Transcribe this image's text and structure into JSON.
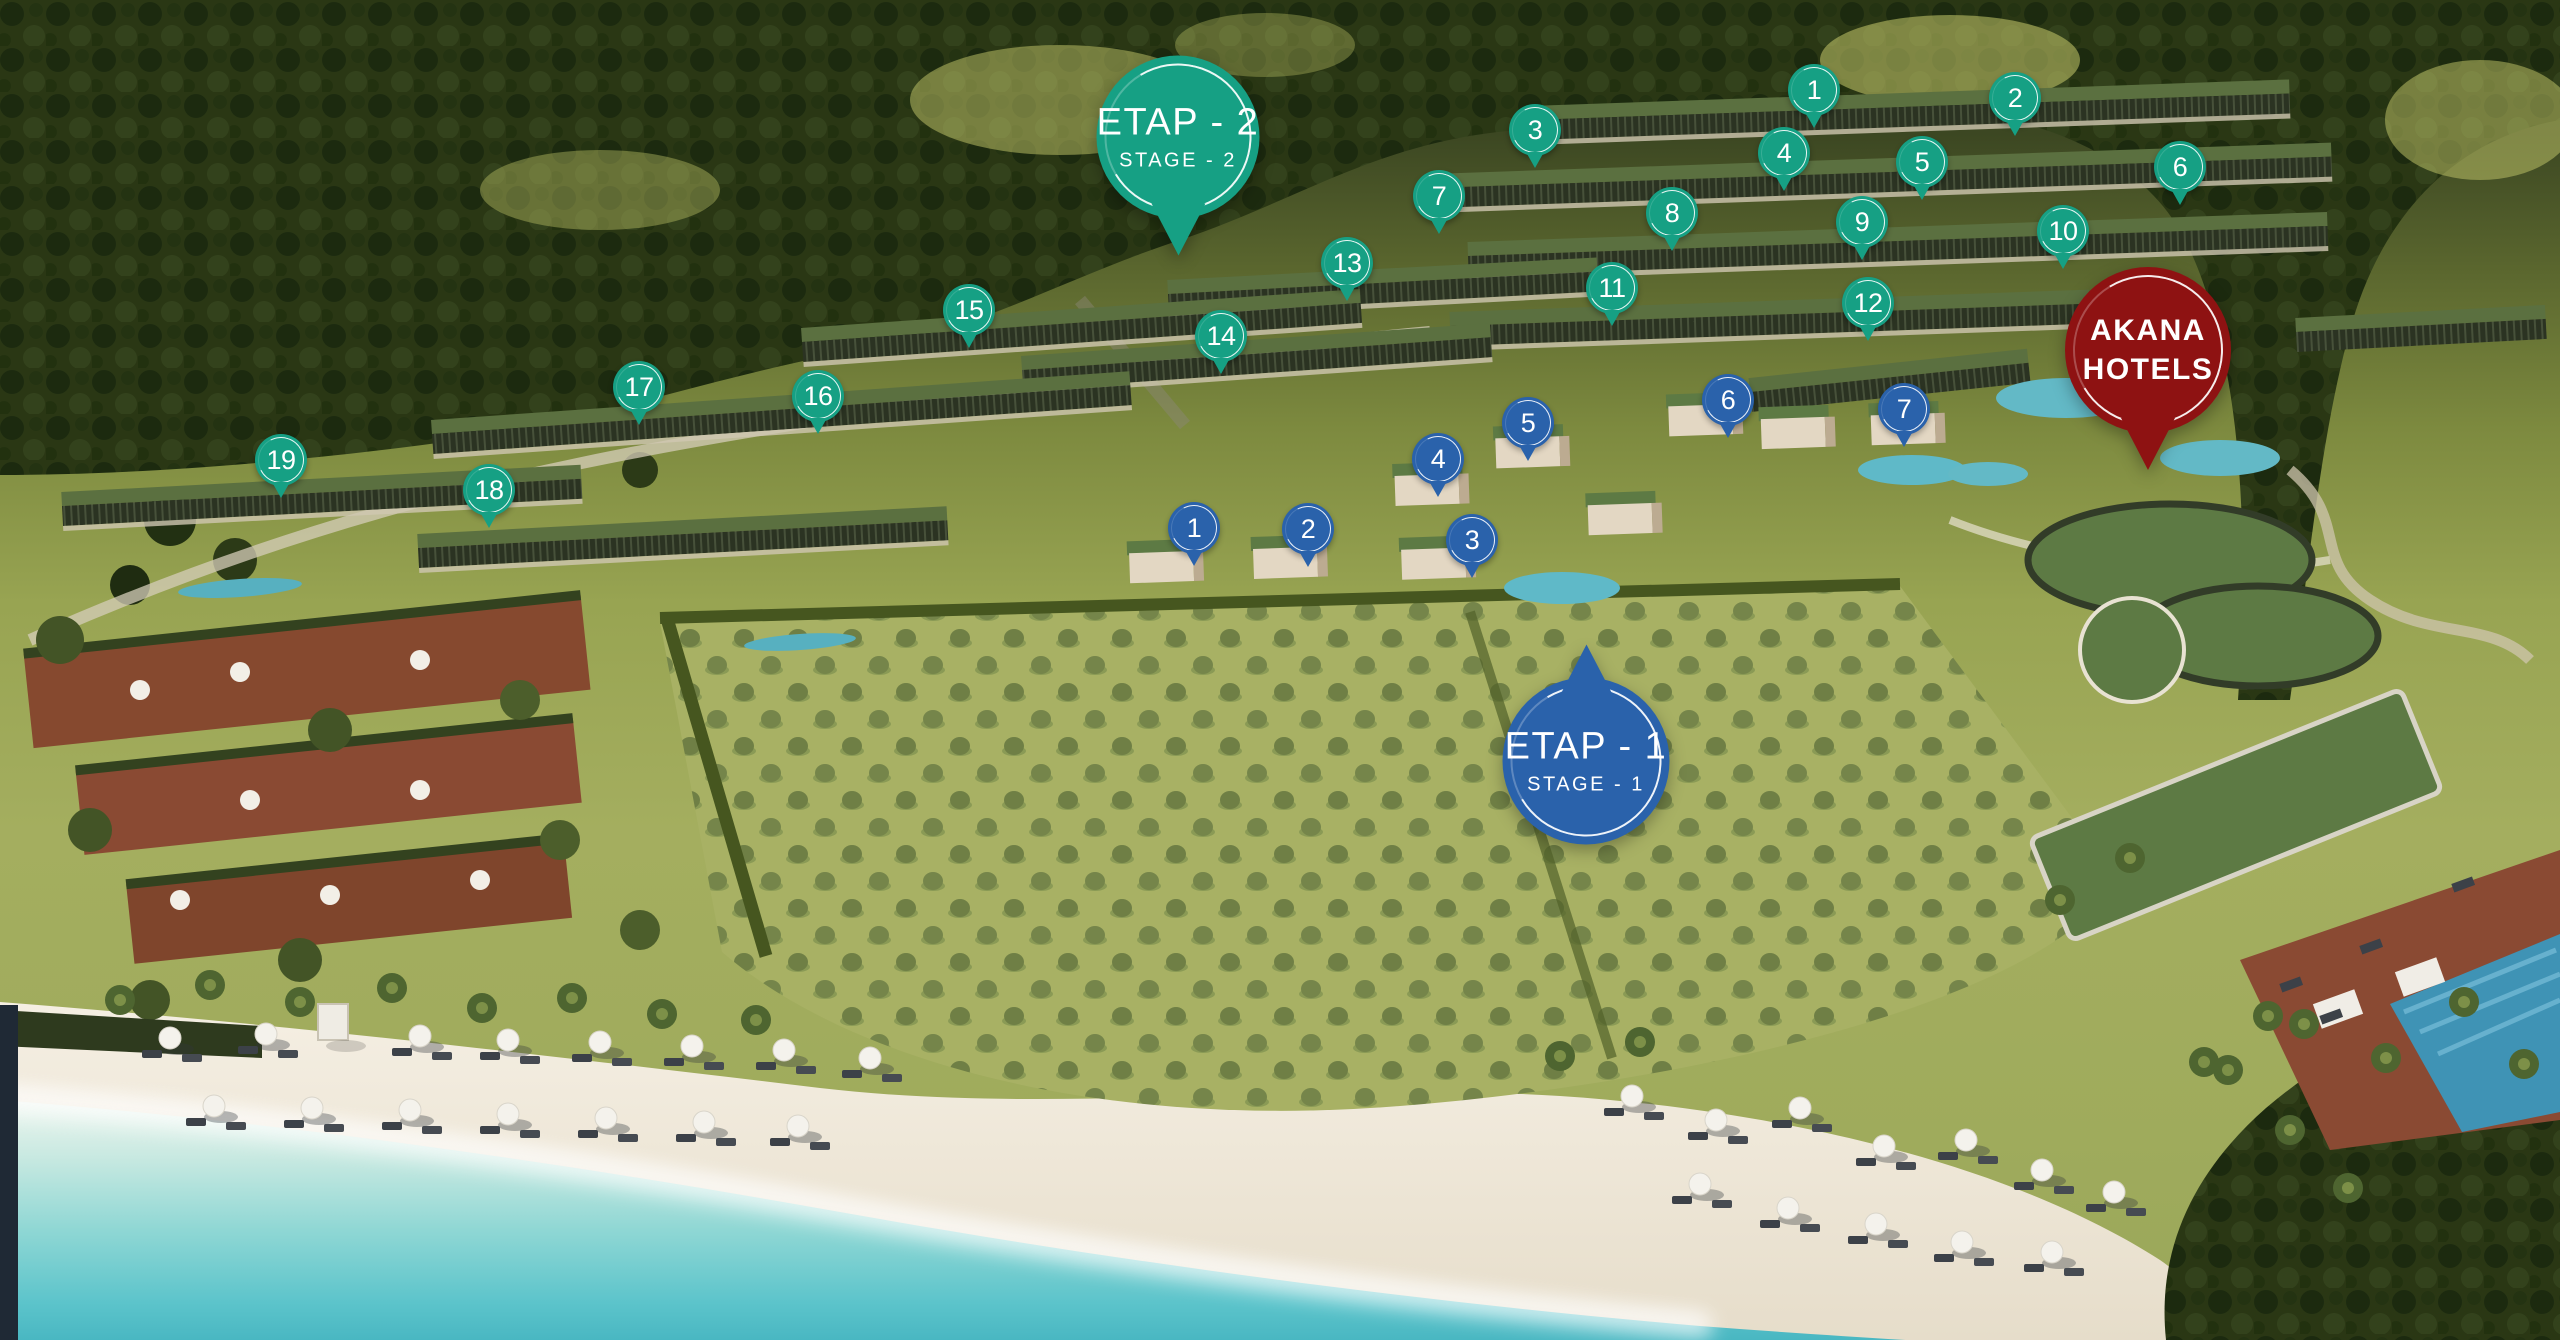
{
  "map": {
    "stages": {
      "stage2": {
        "label_tr": "ETAP - 2",
        "label_en": "STAGE - 2",
        "color": "#16a084",
        "pin_count": 19
      },
      "stage1": {
        "label_tr": "ETAP - 1",
        "label_en": "STAGE - 1",
        "color": "#2a62ab",
        "pin_count": 7
      },
      "hotel": {
        "label_lines": [
          "AKANA",
          "HOTELS"
        ],
        "color": "#8e1212"
      }
    },
    "badges": [
      {
        "id": "stage2-badge",
        "title": "ETAP - 2",
        "subtitle": "STAGE - 2",
        "color": "#16a084",
        "x": 1178,
        "y": 137,
        "d": 163,
        "tail": "down"
      },
      {
        "id": "stage1-badge",
        "title": "ETAP - 1",
        "subtitle": "STAGE - 1",
        "color": "#2a62ab",
        "x": 1586,
        "y": 761,
        "d": 167,
        "tail": "up"
      },
      {
        "id": "akana-hotels-badge",
        "lines": [
          "AKANA",
          "HOTELS"
        ],
        "color": "#8e1212",
        "x": 2148,
        "y": 350,
        "d": 166,
        "tail": "down"
      }
    ],
    "pins": {
      "stage2": [
        {
          "n": "1",
          "x": 1814,
          "y": 90
        },
        {
          "n": "2",
          "x": 2015,
          "y": 98
        },
        {
          "n": "3",
          "x": 1535,
          "y": 130
        },
        {
          "n": "4",
          "x": 1784,
          "y": 153
        },
        {
          "n": "5",
          "x": 1922,
          "y": 162
        },
        {
          "n": "6",
          "x": 2180,
          "y": 167
        },
        {
          "n": "7",
          "x": 1439,
          "y": 196
        },
        {
          "n": "8",
          "x": 1672,
          "y": 213
        },
        {
          "n": "9",
          "x": 1862,
          "y": 222
        },
        {
          "n": "10",
          "x": 2063,
          "y": 231
        },
        {
          "n": "11",
          "x": 1612,
          "y": 288
        },
        {
          "n": "12",
          "x": 1868,
          "y": 303
        },
        {
          "n": "13",
          "x": 1347,
          "y": 263
        },
        {
          "n": "14",
          "x": 1221,
          "y": 336
        },
        {
          "n": "15",
          "x": 969,
          "y": 310
        },
        {
          "n": "16",
          "x": 818,
          "y": 396
        },
        {
          "n": "17",
          "x": 639,
          "y": 387
        },
        {
          "n": "18",
          "x": 489,
          "y": 490
        },
        {
          "n": "19",
          "x": 281,
          "y": 460
        }
      ],
      "stage1": [
        {
          "n": "1",
          "x": 1194,
          "y": 528
        },
        {
          "n": "2",
          "x": 1308,
          "y": 529
        },
        {
          "n": "3",
          "x": 1472,
          "y": 540
        },
        {
          "n": "4",
          "x": 1438,
          "y": 459
        },
        {
          "n": "5",
          "x": 1528,
          "y": 423
        },
        {
          "n": "6",
          "x": 1728,
          "y": 400
        },
        {
          "n": "7",
          "x": 1904,
          "y": 409
        }
      ]
    },
    "scene_colors": {
      "sea": "#4fbcc6",
      "sand": "#efe8da",
      "olive_grove": "#a8b164",
      "forest": "#2a3714",
      "terrace_deck": "#8a4a33",
      "green_roof": "#5b7040"
    }
  }
}
